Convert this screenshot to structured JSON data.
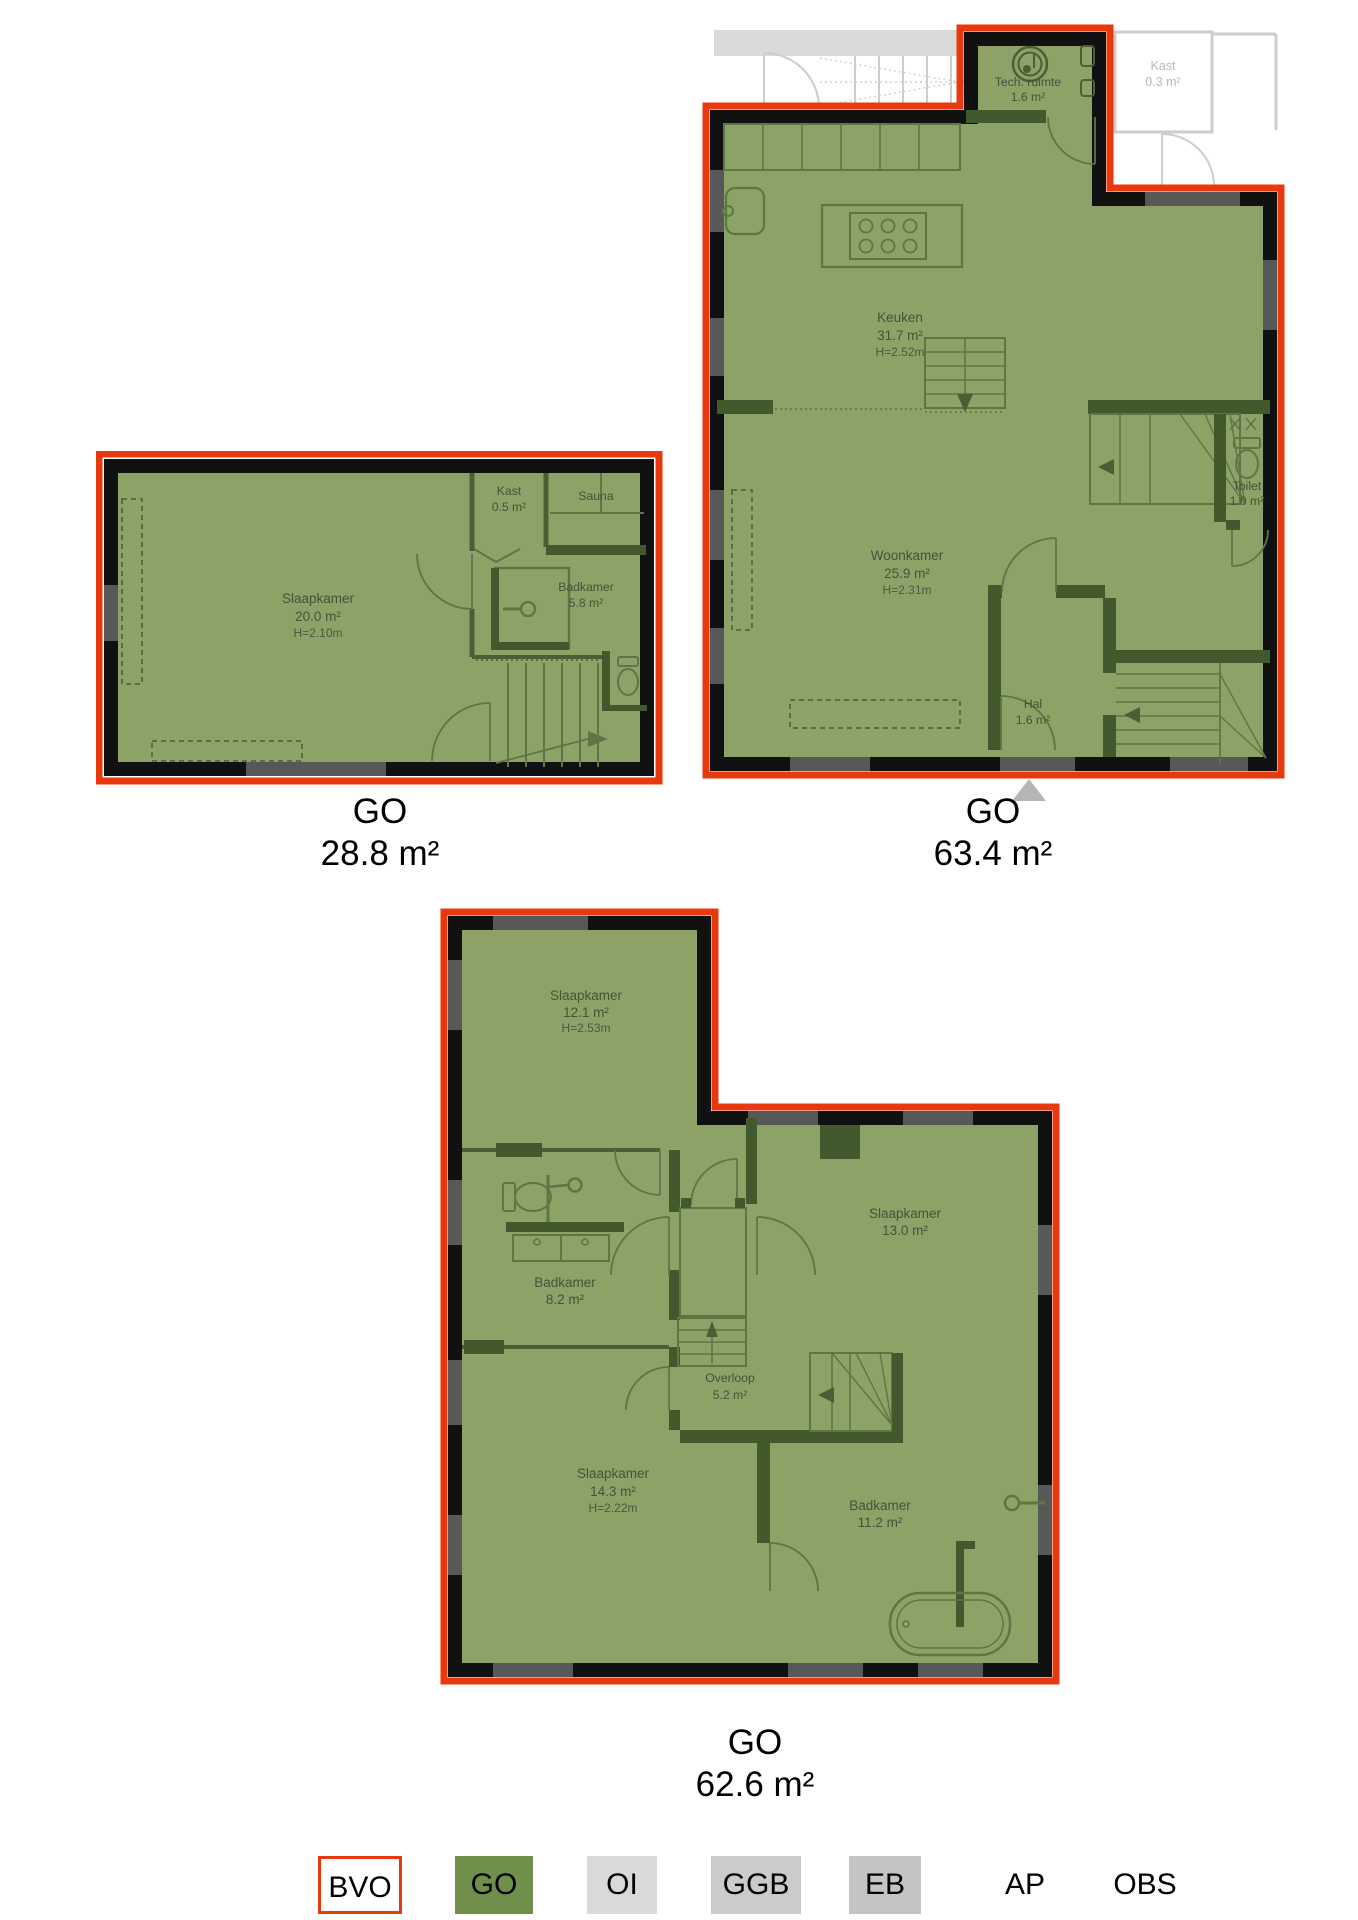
{
  "colors": {
    "go_fill": "#8CA266",
    "bvo_outline": "#E8390E",
    "wall": "#111111",
    "inner_wall": "#42592E",
    "thin_line": "#5C7744",
    "faded": "#CDCDCD",
    "legend_go": "#6F8F4B",
    "legend_oi": "#D9D9D9",
    "legend_ggb": "#CBCBCB",
    "legend_eb": "#C4C4C4"
  },
  "floorplans": [
    {
      "caption": {
        "label": "GO",
        "area": "28.8 m²"
      },
      "rooms": [
        {
          "name": "Slaapkamer",
          "area": "20.0 m²",
          "height": "H=2.10m"
        },
        {
          "name": "Kast",
          "area": "0.5 m²"
        },
        {
          "name": "Sauna"
        },
        {
          "name": "Badkamer",
          "area": "5.8 m²"
        }
      ]
    },
    {
      "caption": {
        "label": "GO",
        "area": "63.4 m²"
      },
      "rooms": [
        {
          "name": "Tech. ruimte",
          "area": "1.6 m²"
        },
        {
          "name": "Kast",
          "area": "0.3 m²",
          "note": "outside-go"
        },
        {
          "name": "Keuken",
          "area": "31.7 m²",
          "height": "H=2.52m"
        },
        {
          "name": "Woonkamer",
          "area": "25.9 m²",
          "height": "H=2.31m"
        },
        {
          "name": "Toilet",
          "area": "1.0 m²"
        },
        {
          "name": "Hal",
          "area": "1.6 m²"
        }
      ]
    },
    {
      "caption": {
        "label": "GO",
        "area": "62.6 m²"
      },
      "rooms": [
        {
          "name": "Slaapkamer",
          "area": "12.1 m²",
          "height": "H=2.53m"
        },
        {
          "name": "Badkamer",
          "area": "8.2 m²"
        },
        {
          "name": "Slaapkamer",
          "area": "13.0 m²"
        },
        {
          "name": "Overloop",
          "area": "5.2 m²"
        },
        {
          "name": "Slaapkamer",
          "area": "14.3 m²",
          "height": "H=2.22m"
        },
        {
          "name": "Badkamer",
          "area": "11.2 m²"
        }
      ]
    }
  ],
  "legend": {
    "items": [
      {
        "label": "BVO"
      },
      {
        "label": "GO"
      },
      {
        "label": "OI"
      },
      {
        "label": "GGB"
      },
      {
        "label": "EB"
      },
      {
        "label": "AP"
      },
      {
        "label": "OBS"
      }
    ]
  }
}
